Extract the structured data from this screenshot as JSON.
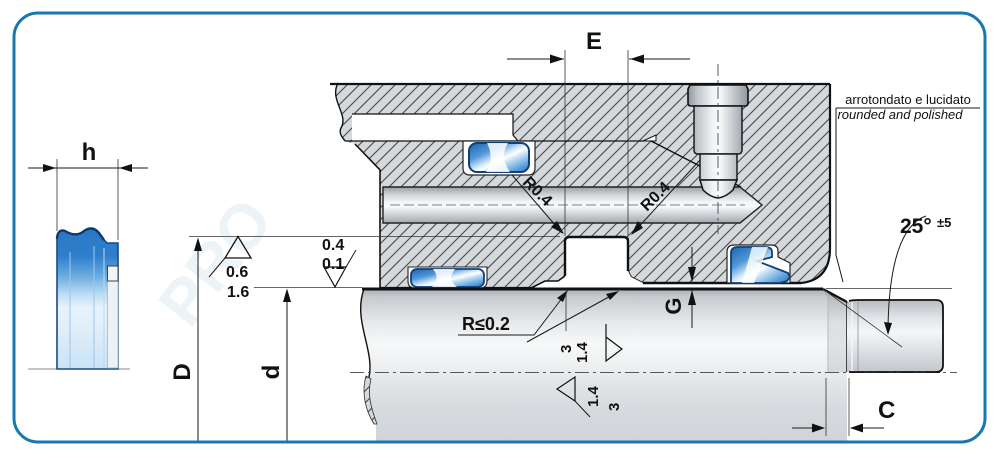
{
  "drawing": {
    "dims": {
      "e": "E",
      "d_outer": "D",
      "d_inner": "d",
      "g": "G",
      "c": "C",
      "h": "h"
    },
    "radii": {
      "groove_top_left": "R0.4",
      "groove_top_right": "R0.4",
      "edge_max": "R≤0.2"
    },
    "angle": {
      "value": "25°",
      "tolerance": "±5"
    },
    "surface": {
      "bore": [
        "0.6",
        "1.6"
      ],
      "rod": [
        "0.4",
        "0.1"
      ],
      "groove_upper": [
        "3",
        "1.4"
      ],
      "groove_lower": [
        "1.4",
        "3"
      ]
    },
    "notes": {
      "edge_it": "arrotondato e lucidato",
      "edge_en": "rounded and polished"
    },
    "watermark": "PRO",
    "colors": {
      "border": "#1878ad",
      "seal_blue": "#2b77c5",
      "seal_outline": "#123f74",
      "hatch_fill": "#d6d9dc",
      "line": "#111111"
    }
  }
}
